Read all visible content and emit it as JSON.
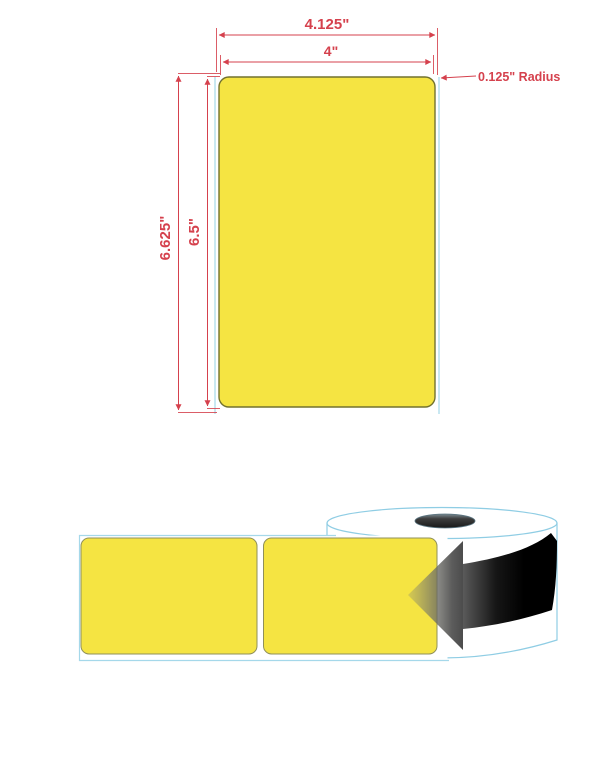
{
  "label_spec": {
    "liner_width": "4.125\"",
    "label_width": "4\"",
    "liner_height": "6.625\"",
    "label_height": "6.5\"",
    "corner_radius": "0.125\" Radius"
  },
  "colors": {
    "label_yellow": "#F5E442",
    "label_outline": "#72722F",
    "dimension_red": "#D5414D",
    "liner_edge_blue": "#A5D8EA",
    "roll_outline_blue": "#8FCDE4",
    "arrow_dark": "#000000"
  }
}
